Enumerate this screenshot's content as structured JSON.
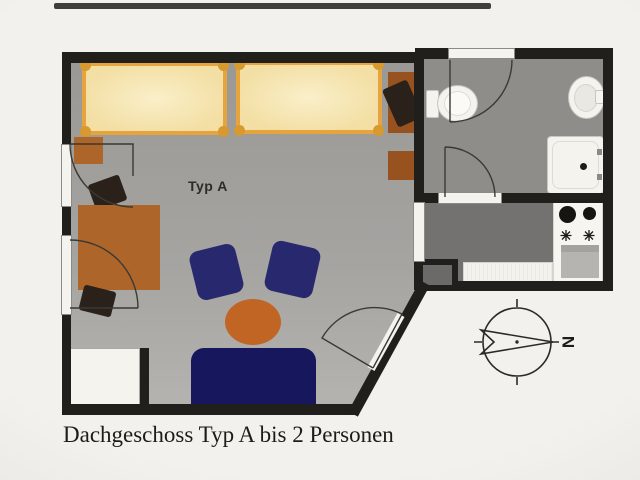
{
  "caption": "Dachgeschoss Typ A bis 2 Personen",
  "room_label": "Typ A",
  "compass": {
    "north_label": "N",
    "orientation": "north points to the right of the plan"
  },
  "plan": {
    "type": "floor-plan",
    "floor": "Dachgeschoss",
    "unit_type": "Typ A",
    "capacity": "bis 2 Personen",
    "rooms": [
      {
        "name": "living-bedroom",
        "label": "Typ A",
        "furniture": [
          "single bed",
          "single bed",
          "desk with office chair",
          "nightstand",
          "nightstand",
          "desk with two chairs",
          "armchair",
          "armchair",
          "round coffee table",
          "sofa",
          "wardrobe"
        ]
      },
      {
        "name": "bathroom",
        "furniture": [
          "toilet",
          "washbasin",
          "shower tray"
        ]
      },
      {
        "name": "kitchen",
        "furniture": [
          "stove with two burners and oven",
          "counter",
          "utility shaft"
        ]
      }
    ]
  },
  "colors": {
    "paper": "#f2f1ed",
    "paper_edge": "#e4e3df",
    "wall": "#201f1c",
    "floor_main_top": "#969591",
    "floor_main_bottom": "#bcbbb7",
    "floor_bath": "#8e8d8a",
    "floor_kitchen": "#747271",
    "bed_frame": "#e5a43d",
    "bed_post": "#d8992f",
    "bed_fill": "#f3dfa4",
    "bed_fill_light": "#faefc9",
    "wood": "#ad6529",
    "wood_dark": "#97521f",
    "chair_dark": "#2b211b",
    "armchair_navy": "#28286e",
    "sofa_navy": "#17175e",
    "table_orange": "#c06524",
    "fixture": "#f4f3ee",
    "fixture_border": "#c7c6c1",
    "appliance_gray": "#b5b4b0",
    "line": "#3a3934",
    "text_dark": "#1d1c19"
  }
}
